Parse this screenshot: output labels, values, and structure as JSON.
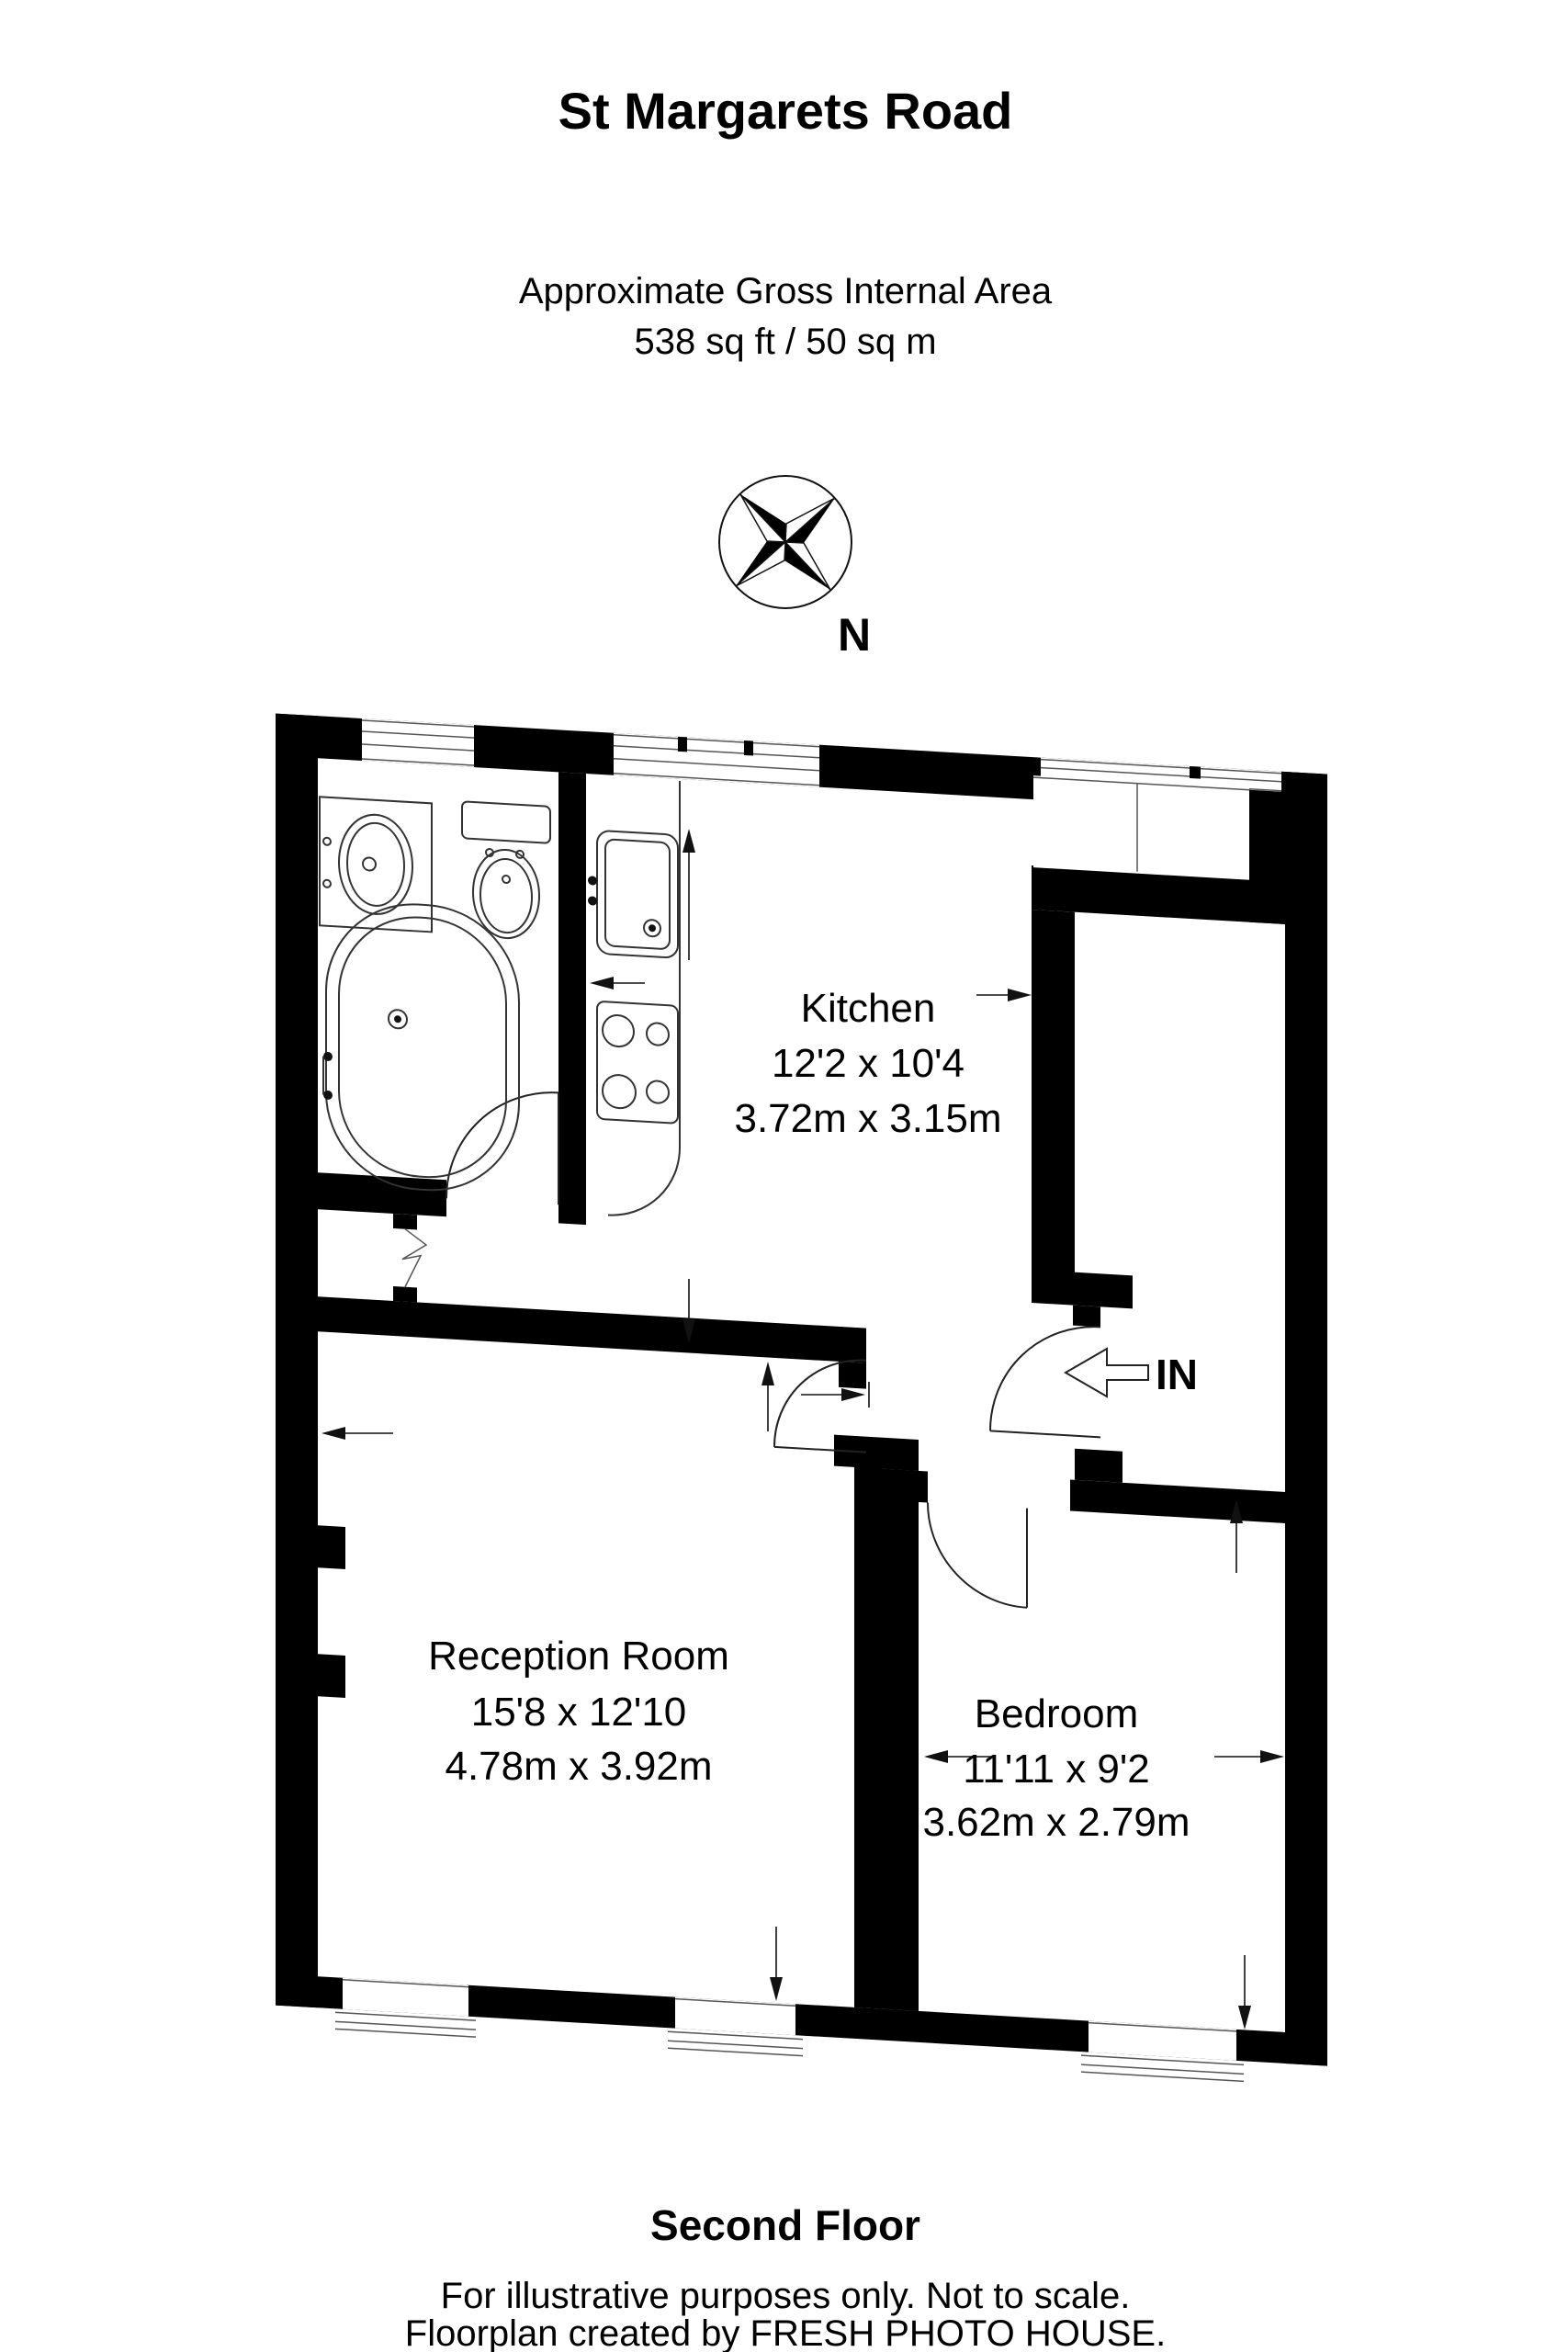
{
  "header": {
    "title": "St Margarets Road",
    "subtitle": "Approximate Gross Internal Area",
    "area": "538 sq ft / 50 sq m"
  },
  "compass": {
    "north_label": "N"
  },
  "entrance": {
    "label": "IN"
  },
  "rooms": [
    {
      "name": "Kitchen",
      "imperial": "12'2 x 10'4",
      "metric": "3.72m x 3.15m"
    },
    {
      "name": "Reception Room",
      "imperial": "15'8 x 12'10",
      "metric": "4.78m x 3.92m"
    },
    {
      "name": "Bedroom",
      "imperial": "11'11 x 9'2",
      "metric": "3.62m x 2.79m"
    }
  ],
  "footer": {
    "floor": "Second Floor",
    "line1": "For illustrative purposes only. Not to scale.",
    "line2": "Floorplan created by FRESH PHOTO HOUSE."
  },
  "colors": {
    "wall": "#000000",
    "background": "#ffffff"
  }
}
